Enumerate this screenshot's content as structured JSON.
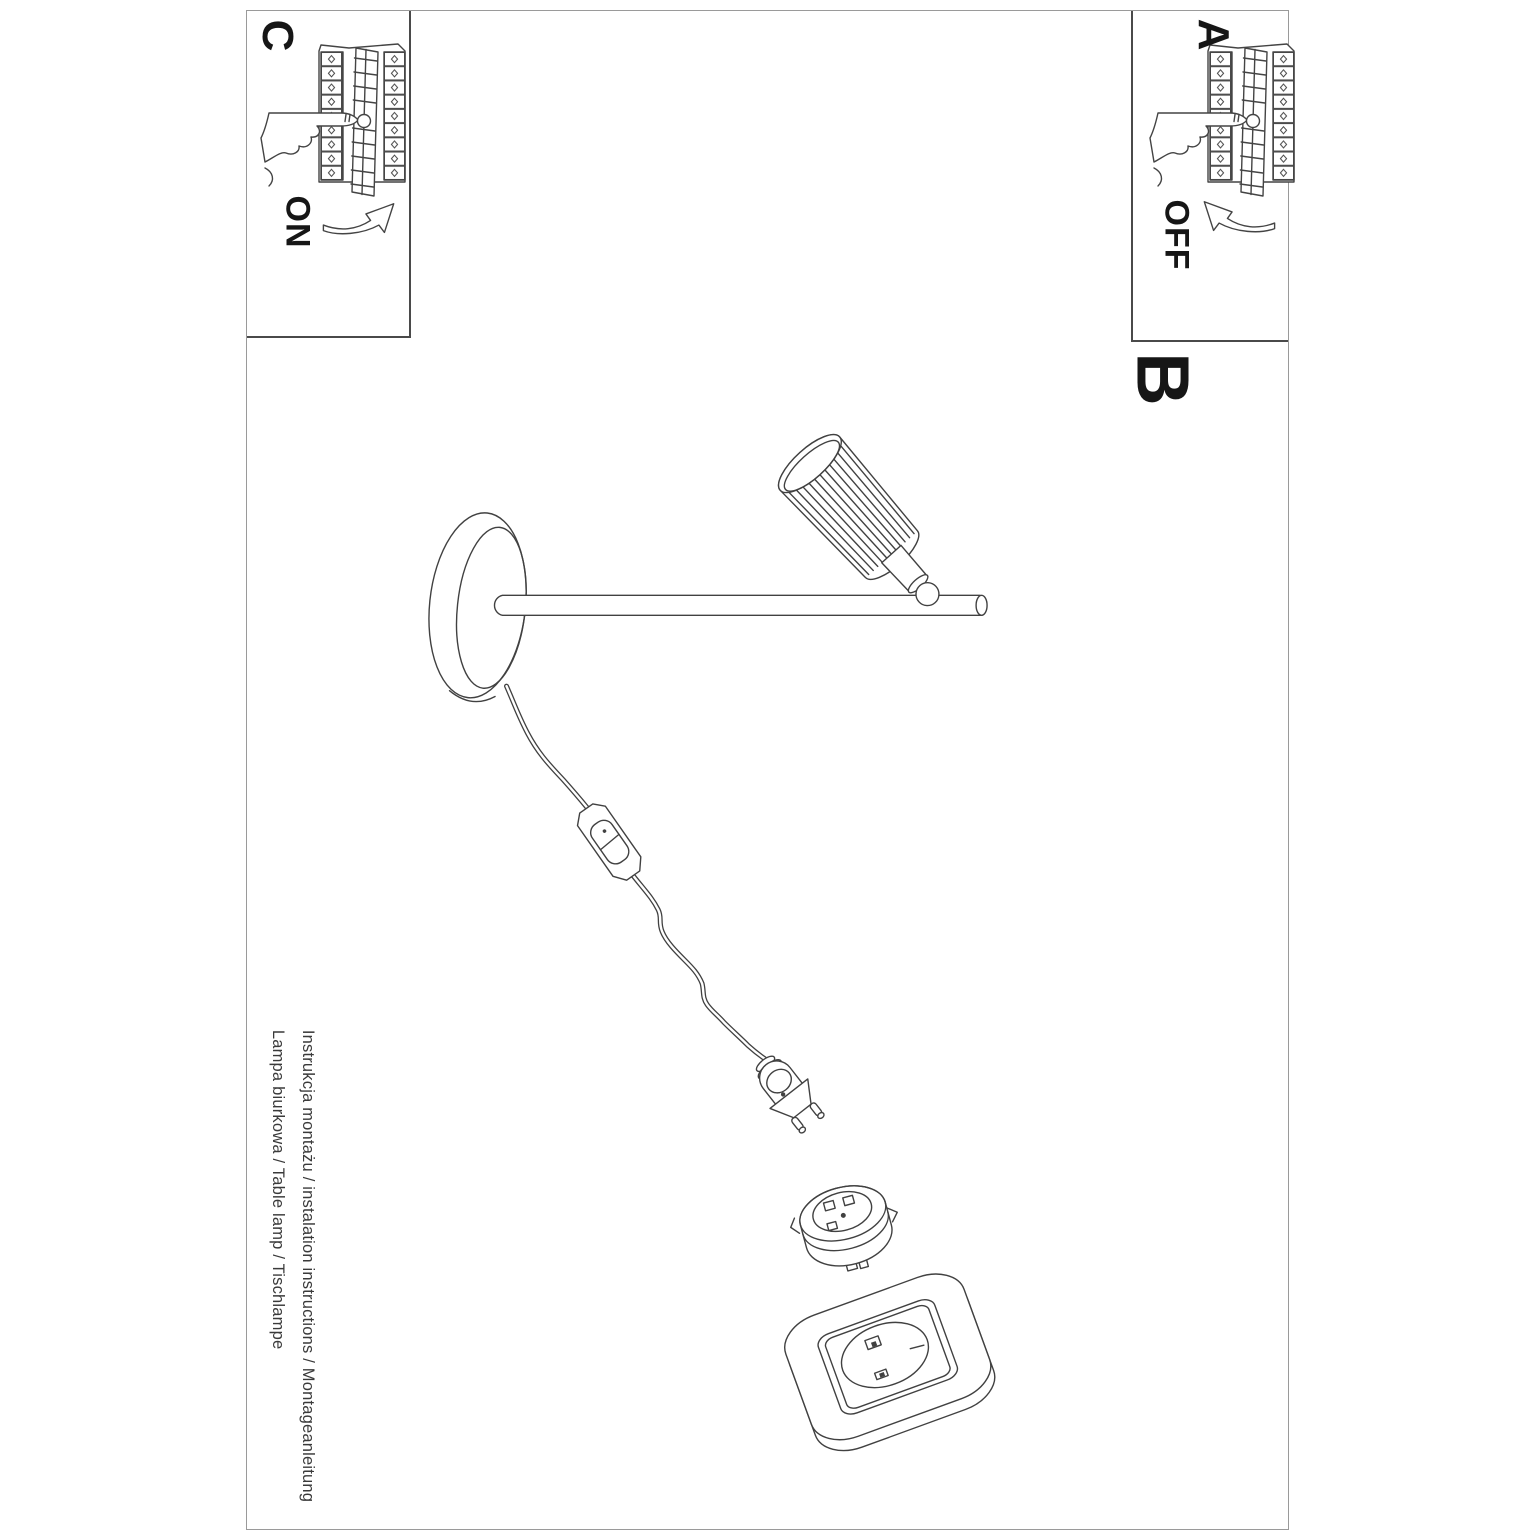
{
  "steps": {
    "a": {
      "label": "A",
      "action": "OFF"
    },
    "b": {
      "label": "B"
    },
    "c": {
      "label": "C",
      "action": "ON"
    }
  },
  "footer": {
    "line1": "Instrukcja montażu / instalation instructions / Montageanleitung",
    "line2": "Lampa biurkowa / Table lamp / Tischlampe"
  },
  "icons": {
    "breaker_panel": "breaker-panel-with-pressing-hand-icon",
    "arrow_on": "curved-arrow-up-right-icon",
    "arrow_off": "curved-arrow-up-left-icon",
    "lamp_drawing_parts": [
      "lamp-head",
      "lamp-rod",
      "lamp-base",
      "power-cord",
      "cord-switch",
      "power-plug",
      "socket-insert-module",
      "wall-socket"
    ]
  },
  "colors": {
    "background": "#ffffff",
    "page_border": "#9a9a9a",
    "box_border": "#4a4a4a",
    "line_art": "#414141",
    "text": "#161616"
  },
  "orientation": {
    "text_rotation_deg": 90
  }
}
